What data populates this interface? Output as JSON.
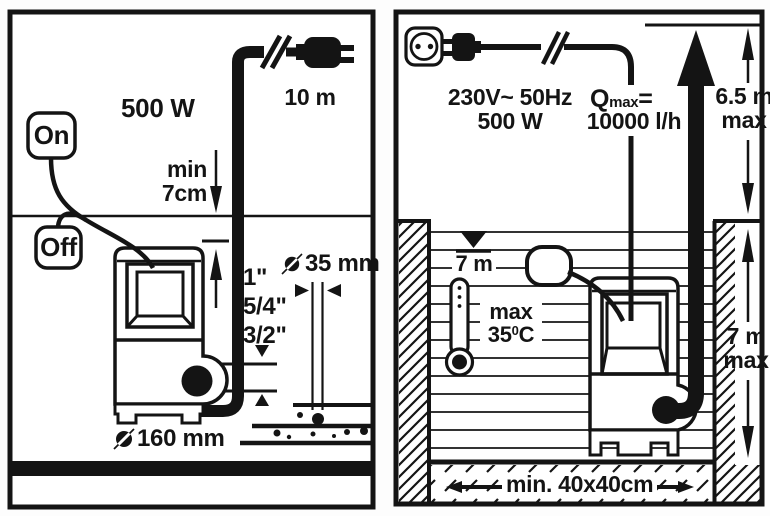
{
  "colors": {
    "ink": "#141414",
    "paper": "#ffffff"
  },
  "left_panel": {
    "power": "500 W",
    "cable_length": "10 m",
    "switch_on": "On",
    "switch_off": "Off",
    "min_level_line1": "min",
    "min_level_line2": "7cm",
    "thread_size_1": "1\"",
    "thread_size_2": "5/4\"",
    "thread_size_3": "3/2\"",
    "grain_diameter": "35 mm",
    "base_diameter": "160 mm"
  },
  "right_panel": {
    "voltage": "230V~ 50Hz",
    "power": "500 W",
    "flow_symbol": "Q",
    "flow_subscript": "max",
    "flow_equals": "=",
    "flow_value": "10000 l/h",
    "head_value": "6.5 m",
    "head_qualifier": "max",
    "level_mark": "7 m",
    "temp_qualifier": "max",
    "temp_value": "35",
    "temp_degree": "0",
    "temp_unit": "C",
    "depth_value": "7 m",
    "depth_qualifier": "max",
    "pit_size": "min. 40x40cm"
  }
}
